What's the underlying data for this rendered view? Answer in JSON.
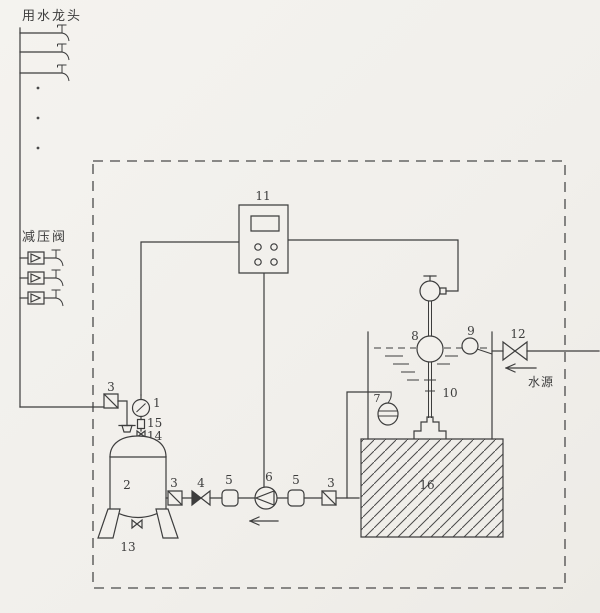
{
  "page": {
    "background_color": "#f2f0ec",
    "line_color": "#3d3d3d"
  },
  "labels": {
    "faucet_header": "用水龙头",
    "pressure_reducing_valve": "减压阀",
    "water_source": "水源"
  },
  "numbers": {
    "c1": "1",
    "c2": "2",
    "c3": "3",
    "c4": "4",
    "c5": "5",
    "c6": "6",
    "c7": "7",
    "c8": "8",
    "c9": "9",
    "c10": "10",
    "c11": "11",
    "c12": "12",
    "c13": "13",
    "c14": "14",
    "c15": "15",
    "c16": "16"
  }
}
